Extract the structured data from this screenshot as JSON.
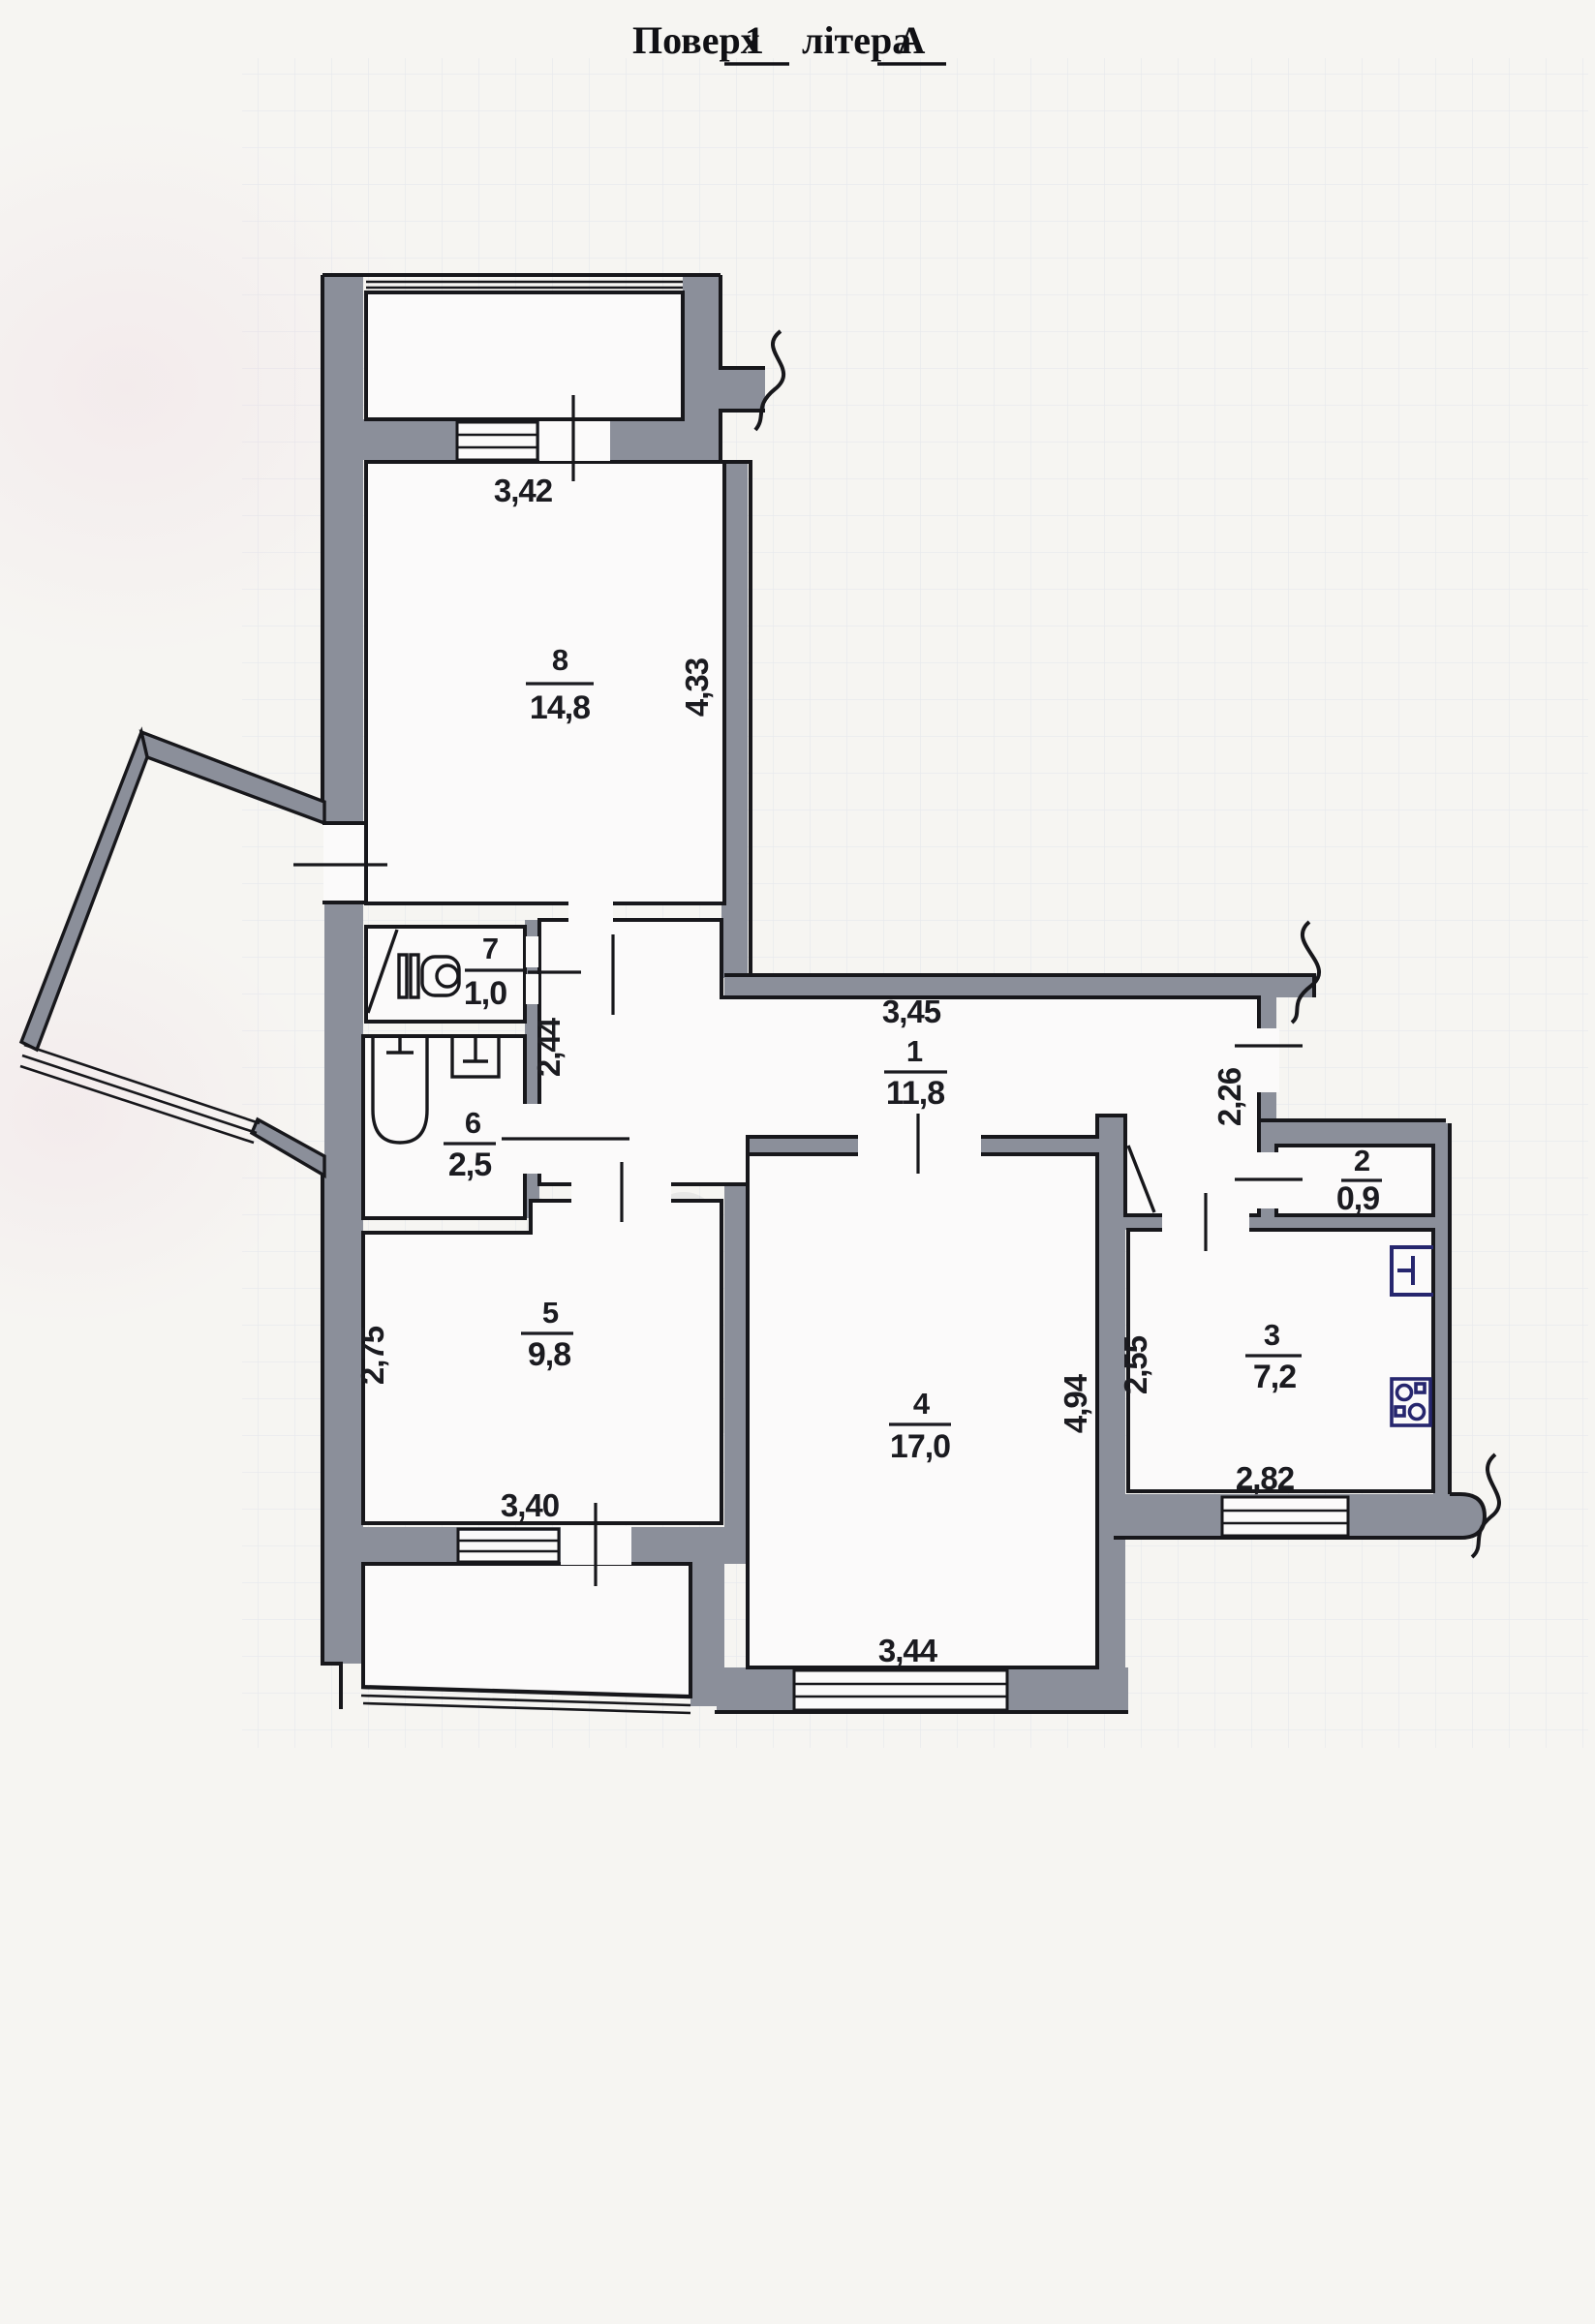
{
  "document": {
    "type": "apartment floor plan (scanned)",
    "title": {
      "label": "Поверх",
      "floor": "1",
      "middle": "літера",
      "letter": "А"
    }
  },
  "plan": {
    "rooms": [
      {
        "id": "8",
        "area": "14,8"
      },
      {
        "id": "7",
        "area": "1,0"
      },
      {
        "id": "6",
        "area": "2,5"
      },
      {
        "id": "5",
        "area": "9,8"
      },
      {
        "id": "1",
        "area": "11,8"
      },
      {
        "id": "2",
        "area": "0,9"
      },
      {
        "id": "3",
        "area": "7,2"
      },
      {
        "id": "4",
        "area": "17,0"
      }
    ],
    "dimensions": {
      "d342": "3,42",
      "d433": "4,33",
      "d244": "2,44",
      "d345": "3,45",
      "d226": "2,26",
      "d275": "2,75",
      "d340": "3,40",
      "d255": "2,55",
      "d494": "4,94",
      "d282": "2,82",
      "d344": "3,44"
    },
    "icons": [
      "toilet-icon",
      "bathtub-icon",
      "sink-icon",
      "kitchen-sink-icon",
      "stove-icon",
      "door-swing-icon",
      "window-lines-icon"
    ],
    "colors": {
      "wall": "#8b8f9a",
      "line": "#17171b",
      "paper": "#f6f5f2",
      "grid": "#aebadd",
      "fixture_ink": "#26266e"
    }
  }
}
